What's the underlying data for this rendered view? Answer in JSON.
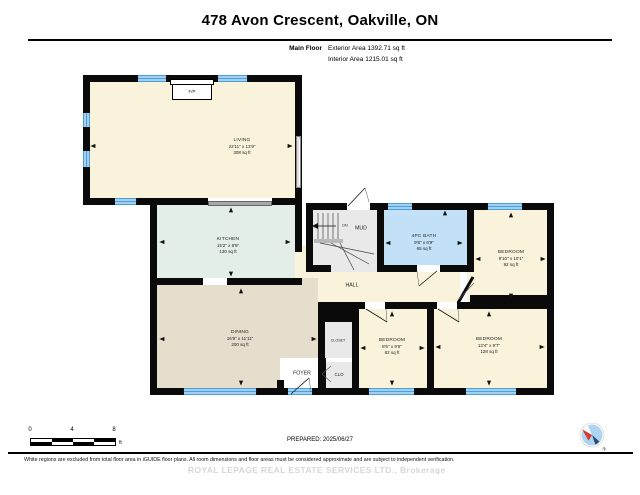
{
  "header": {
    "title": "478 Avon Crescent, Oakville, ON",
    "floor_label": "Main Floor",
    "exterior_area": "Exterior Area 1392.71 sq ft",
    "interior_area": "Interior Area 1215.01 sq ft"
  },
  "rooms": {
    "living": {
      "name": "LIVING",
      "dims": "22'11\" x 13'9\"",
      "area": "308 sq ft"
    },
    "kitchen": {
      "name": "KITCHEN",
      "dims": "15'2\" x 8'9\"",
      "area": "130 sq ft"
    },
    "bath": {
      "name": "4PC BATH",
      "dims": "9'8\" x 6'9\"",
      "area": "65 sq ft"
    },
    "bedroom_right": {
      "name": "BEDROOM",
      "dims": "9'10\" x 10'1\"",
      "area": "92 sq ft"
    },
    "bedroom_mid": {
      "name": "BEDROOM",
      "dims": "8'6\" x 9'6\"",
      "area": "82 sq ft"
    },
    "bedroom_bottom": {
      "name": "BEDROOM",
      "dims": "13'4\" x 9'7\"",
      "area": "128 sq ft"
    },
    "dining": {
      "name": "DINING",
      "dims": "16'9\" x 11'11\"",
      "area": "200 sq ft"
    },
    "hall": {
      "name": "HALL"
    },
    "mud": {
      "name": "MUD",
      "stairs_label": "DN"
    },
    "foyer": {
      "name": "FOYER"
    },
    "closet": {
      "name": "CLOSET"
    },
    "clo": {
      "name": "CLO"
    },
    "fireplace": {
      "label": "F/P"
    }
  },
  "footer": {
    "scale": {
      "t0": "0",
      "t4": "4",
      "t8": "8",
      "unit": "ft"
    },
    "prepared": "PREPARED: 2025/06/27",
    "disclaimer": "White regions are excluded from total floor area in iGUIDE floor plans. All room dimensions and floor areas must be considered approximate and are subject to independent verification.",
    "watermark": "ROYAL LEPAGE REAL ESTATE SERVICES LTD., Brokerage",
    "compass_icon": "compass-north-icon"
  },
  "colors": {
    "wall": "#0a0a0a",
    "window_blue": "#4A9FDE",
    "room_cream": "#FAF3DB",
    "kitchen_teal": "#E3EEE9",
    "dining_tan": "#E5DECD",
    "bath_blue": "#C2E1F7",
    "gray_room": "#E9E9E9"
  }
}
